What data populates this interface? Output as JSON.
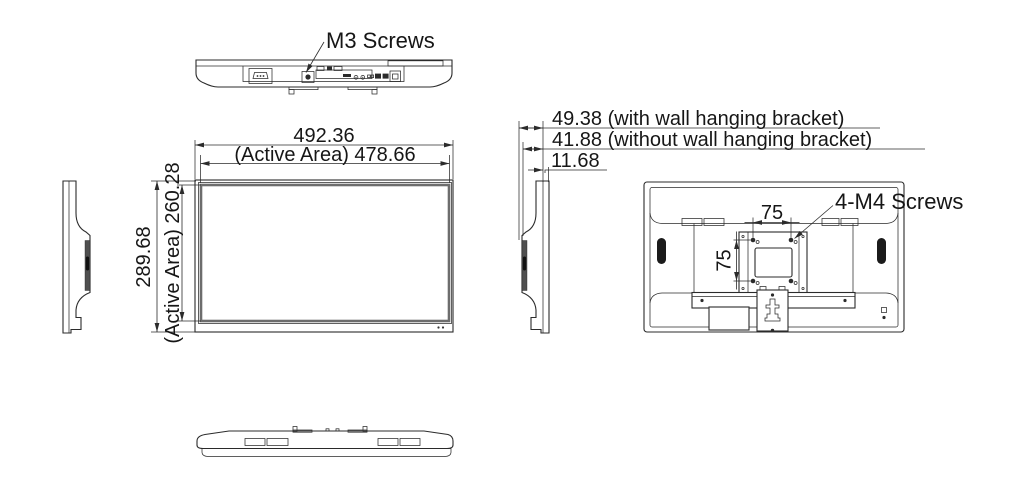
{
  "labels": {
    "m3_screws": "M3 Screws",
    "m4_screws": "4-M4 Screws"
  },
  "dimensions": {
    "overall_width": "492.36",
    "active_width": "(Active Area) 478.66",
    "overall_height": "289.68",
    "active_height": "(Active Area) 260.28",
    "depth_with_bracket": "49.38 (with wall hanging bracket)",
    "depth_without_bracket": "41.88 (without wall hanging bracket)",
    "panel_depth": "11.68",
    "vesa_width": "75",
    "vesa_height": "75"
  },
  "colors": {
    "line": "#2b2b2b",
    "background": "#ffffff",
    "bezel": "#6d6d6d"
  }
}
